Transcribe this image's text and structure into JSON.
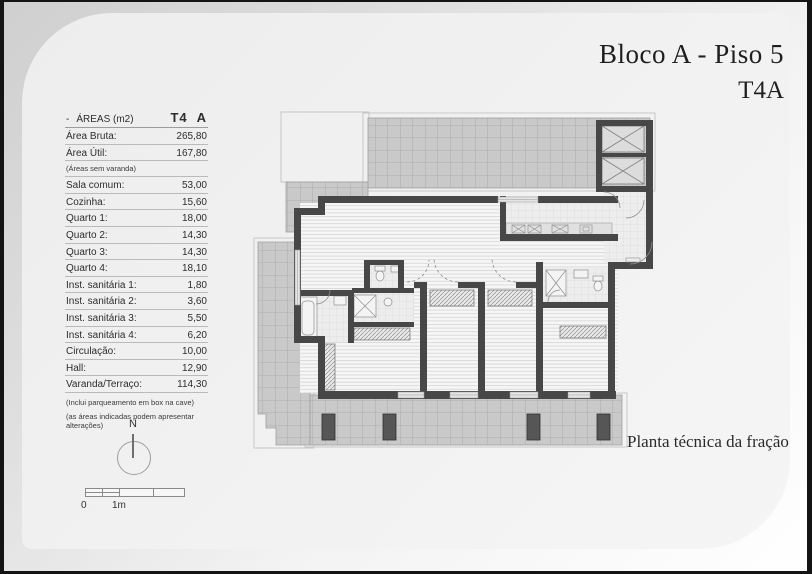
{
  "header": {
    "title": "Bloco A - Piso 5",
    "unit": "T4A"
  },
  "caption": "Planta técnica da fração",
  "areas_table": {
    "header": {
      "dash": "-",
      "title": "ÁREAS (m2)",
      "type": "T4",
      "fraction": "A"
    },
    "rows": [
      {
        "label": "Área Bruta:",
        "value": "265,80"
      },
      {
        "label": "Área Útil:",
        "value": "167,80"
      },
      {
        "label": "Sala comum:",
        "value": "53,00"
      },
      {
        "label": "Cozinha:",
        "value": "15,60"
      },
      {
        "label": "Quarto 1:",
        "value": "18,00"
      },
      {
        "label": "Quarto 2:",
        "value": "14,30"
      },
      {
        "label": "Quarto 3:",
        "value": "14,30"
      },
      {
        "label": "Quarto 4:",
        "value": "18,10"
      },
      {
        "label": "Inst. sanitária 1:",
        "value": "1,80"
      },
      {
        "label": "Inst. sanitária 2:",
        "value": "3,60"
      },
      {
        "label": "Inst. sanitária 3:",
        "value": "5,50"
      },
      {
        "label": "Inst. sanitária 4:",
        "value": "6,20"
      },
      {
        "label": "Circulação:",
        "value": "10,00"
      },
      {
        "label": "Hall:",
        "value": "12,90"
      },
      {
        "label": "Varanda/Terraço:",
        "value": "114,30"
      }
    ],
    "subnote": "(Áreas sem varanda)",
    "footnotes": [
      "(Inclui parqueamento em box na cave)",
      "(as áreas indicadas podem apresentar alterações)"
    ]
  },
  "compass": {
    "north": "N"
  },
  "scale": {
    "zero": "0",
    "one_meter": "1m"
  },
  "colors": {
    "wall": "#474747",
    "terrace": "#c9c9c9",
    "floor": "#f5f5f5",
    "page": "#f0f0f0",
    "frame": "#141414"
  }
}
